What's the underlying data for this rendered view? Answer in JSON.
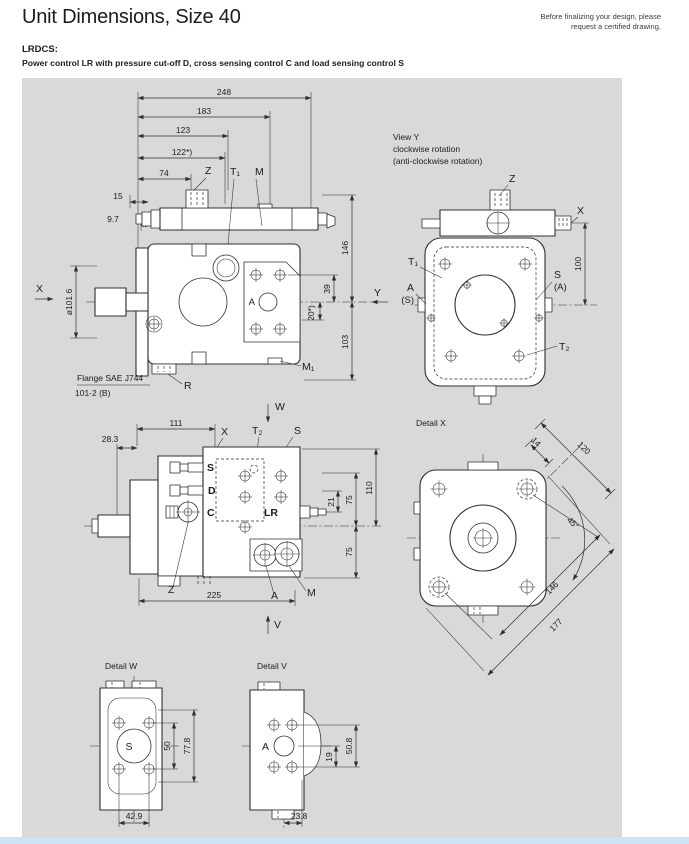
{
  "header": {
    "title": "Unit Dimensions, Size 40",
    "note_line1": "Before finalizing your design, please",
    "note_line2": "request a certified drawing.",
    "model": "LRDCS:",
    "subtitle": "Power control LR with pressure cut-off D, cross sensing control C and load sensing control S"
  },
  "main_view": {
    "dim_248": "248",
    "dim_183": "183",
    "dim_123": "123",
    "dim_122": "122*)",
    "dim_74": "74",
    "dim_15": "15",
    "dim_9_7": "9.7",
    "dia_101_6": "ø101.6",
    "label_x": "X",
    "label_y": "Y",
    "label_z": "Z",
    "label_t1": "T₁",
    "label_m": "M",
    "label_a": "A",
    "label_m1": "M₁",
    "label_r": "R",
    "dim_146": "146",
    "dim_39": "39",
    "dim_20": "20*)",
    "dim_103": "103",
    "flange_line1": "Flange SAE J744",
    "flange_line2": "101-2 (B)"
  },
  "view_y": {
    "title": "View Y",
    "sub1": "clockwise rotation",
    "sub2": "(anti-clockwise rotation)",
    "label_z": "Z",
    "label_x": "X",
    "label_t1": "T₁",
    "label_a": "A",
    "label_a_alt": "(S)",
    "label_s": "S",
    "label_s_alt": "(A)",
    "label_t2": "T₂",
    "dim_100": "100"
  },
  "side_view2": {
    "label_w": "W",
    "dim_111": "111",
    "label_x": "X",
    "label_t2": "T₂",
    "label_s_top": "S",
    "dim_28_3": "28.3",
    "port_s": "S",
    "port_d": "D",
    "port_c": "C",
    "port_lr": "LR",
    "dim_21": "21",
    "dim_75_top": "75",
    "dim_110": "110",
    "dim_75_bottom": "75",
    "label_z": "Z",
    "dim_225": "225",
    "label_a": "A",
    "label_m": "M",
    "label_v": "V"
  },
  "detail_x": {
    "title": "Detail X",
    "dim_120": "120",
    "dim_14": "14",
    "dim_45": "45°",
    "dim_146": "146",
    "dim_177": "177"
  },
  "detail_w": {
    "title": "Detail W",
    "port": "S",
    "dim_50": "50",
    "dim_77_8": "77.8",
    "dim_42_9": "42.9"
  },
  "detail_v": {
    "title": "Detail V",
    "port": "A",
    "dim_50_8": "50.8",
    "dim_19": "19",
    "dim_23_8": "23.8"
  },
  "colors": {
    "page_bg": "#ffffff",
    "canvas_bg": "#d9d9d9",
    "line": "#2f2f2f",
    "body_fill": "#ffffff",
    "footer_strip": "#cfe4f0"
  }
}
